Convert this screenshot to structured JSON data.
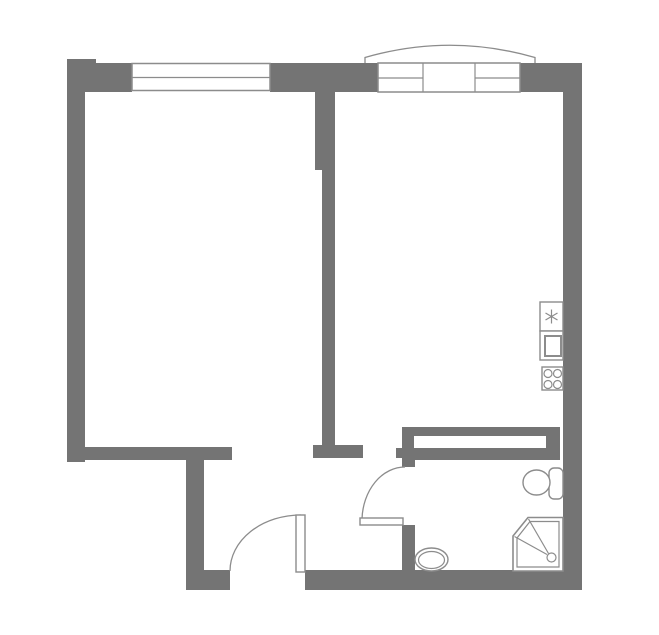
{
  "plan": {
    "width": 659,
    "height": 635,
    "colors": {
      "wall": "#747474",
      "line": "#8c8c8c",
      "white": "#ffffff",
      "background": "#ffffff"
    },
    "elements": [
      {
        "name": "top-left-corner-block",
        "shapes": [
          {
            "kind": "rect",
            "x": 67,
            "y": 59,
            "w": 29,
            "h": 33,
            "fill": "wall"
          }
        ]
      },
      {
        "name": "top-wall-left",
        "shapes": [
          {
            "kind": "rect",
            "x": 96,
            "y": 63,
            "w": 36,
            "h": 29,
            "fill": "wall"
          }
        ]
      },
      {
        "name": "top-wall-middle",
        "shapes": [
          {
            "kind": "rect",
            "x": 270,
            "y": 63,
            "w": 108,
            "h": 29,
            "fill": "wall"
          }
        ]
      },
      {
        "name": "top-wall-right",
        "shapes": [
          {
            "kind": "rect",
            "x": 518,
            "y": 63,
            "w": 64,
            "h": 29,
            "fill": "wall"
          }
        ]
      },
      {
        "name": "left-wall",
        "shapes": [
          {
            "kind": "rect",
            "x": 67,
            "y": 92,
            "w": 18,
            "h": 370,
            "fill": "wall"
          }
        ]
      },
      {
        "name": "right-wall",
        "shapes": [
          {
            "kind": "rect",
            "x": 563,
            "y": 92,
            "w": 19,
            "h": 498,
            "fill": "wall"
          }
        ]
      },
      {
        "name": "interior-wall-upper",
        "shapes": [
          {
            "kind": "rect",
            "x": 315,
            "y": 92,
            "w": 20,
            "h": 78,
            "fill": "wall"
          }
        ]
      },
      {
        "name": "interior-wall-lower",
        "shapes": [
          {
            "kind": "rect",
            "x": 322,
            "y": 170,
            "w": 13,
            "h": 278,
            "fill": "wall"
          }
        ]
      },
      {
        "name": "interior-wall-foot",
        "shapes": [
          {
            "kind": "rect",
            "x": 313,
            "y": 445,
            "w": 50,
            "h": 13,
            "fill": "wall"
          }
        ]
      },
      {
        "name": "living-room-south-wall",
        "shapes": [
          {
            "kind": "rect",
            "x": 67,
            "y": 447,
            "w": 165,
            "h": 13,
            "fill": "wall"
          }
        ]
      },
      {
        "name": "hall-west-wall",
        "shapes": [
          {
            "kind": "rect",
            "x": 186,
            "y": 447,
            "w": 18,
            "h": 143,
            "fill": "wall"
          }
        ]
      },
      {
        "name": "south-wall-left",
        "shapes": [
          {
            "kind": "rect",
            "x": 186,
            "y": 570,
            "w": 44,
            "h": 20,
            "fill": "wall"
          }
        ]
      },
      {
        "name": "south-wall-right",
        "shapes": [
          {
            "kind": "rect",
            "x": 305,
            "y": 570,
            "w": 277,
            "h": 20,
            "fill": "wall"
          }
        ]
      },
      {
        "name": "bathroom-wall-upper",
        "shapes": [
          {
            "kind": "rect",
            "x": 402,
            "y": 427,
            "w": 13,
            "h": 40,
            "fill": "wall"
          }
        ]
      },
      {
        "name": "bathroom-wall-nub",
        "shapes": [
          {
            "kind": "rect",
            "x": 396,
            "y": 448,
            "w": 20,
            "h": 10,
            "fill": "wall"
          }
        ]
      },
      {
        "name": "bathroom-wall-lower",
        "shapes": [
          {
            "kind": "rect",
            "x": 402,
            "y": 525,
            "w": 13,
            "h": 46,
            "fill": "wall"
          }
        ]
      },
      {
        "name": "bathroom-north-wall",
        "shapes": [
          {
            "kind": "rect",
            "x": 402,
            "y": 448,
            "w": 158,
            "h": 12,
            "fill": "wall"
          }
        ]
      },
      {
        "name": "built-in-wardrobe",
        "shapes": [
          {
            "kind": "rect",
            "x": 402,
            "y": 427,
            "w": 158,
            "h": 21,
            "fill": "wall"
          },
          {
            "kind": "rect",
            "x": 414,
            "y": 436,
            "w": 132,
            "h": 12,
            "fill": "white"
          }
        ]
      },
      {
        "name": "window-living-room",
        "shapes": [
          {
            "kind": "rect",
            "x": 132,
            "y": 63.5,
            "w": 138,
            "h": 27,
            "fill": "white",
            "stroke": "line",
            "sw": 1.5
          },
          {
            "kind": "line",
            "x1": 132,
            "y1": 77.5,
            "x2": 270,
            "y2": 77.5,
            "stroke": "line",
            "sw": 1.2
          }
        ]
      },
      {
        "name": "balcony-window-unit",
        "shapes": [
          {
            "kind": "rect",
            "x": 378,
            "y": 63,
            "w": 142,
            "h": 29,
            "fill": "white",
            "stroke": "line",
            "sw": 1.5
          },
          {
            "kind": "line",
            "x1": 423,
            "y1": 63,
            "x2": 423,
            "y2": 92,
            "stroke": "line",
            "sw": 1.2
          },
          {
            "kind": "line",
            "x1": 475,
            "y1": 63,
            "x2": 475,
            "y2": 92,
            "stroke": "line",
            "sw": 1.2
          },
          {
            "kind": "line",
            "x1": 378,
            "y1": 78,
            "x2": 423,
            "y2": 78,
            "stroke": "line",
            "sw": 1.2
          },
          {
            "kind": "line",
            "x1": 475,
            "y1": 78,
            "x2": 520,
            "y2": 78,
            "stroke": "line",
            "sw": 1.2
          }
        ]
      },
      {
        "name": "balcony-outline",
        "shapes": [
          {
            "kind": "path",
            "d": "M 365 63 L 365 57.5 Q 450 33 535 57.5 L 535 63",
            "fill": "none",
            "stroke": "line",
            "sw": 1.3
          }
        ]
      },
      {
        "name": "entrance-door",
        "shapes": [
          {
            "kind": "path",
            "d": "M 230 571 A 71 56 0 0 1 301 515",
            "fill": "none",
            "stroke": "line",
            "sw": 1.3
          },
          {
            "kind": "rect",
            "x": 296,
            "y": 515,
            "w": 9,
            "h": 57,
            "fill": "white",
            "stroke": "line",
            "sw": 1.4
          }
        ]
      },
      {
        "name": "bathroom-door",
        "shapes": [
          {
            "kind": "path",
            "d": "M 405 467 A 43 54 0 0 0 362 519",
            "fill": "none",
            "stroke": "line",
            "sw": 1.3
          },
          {
            "kind": "rect",
            "x": 360,
            "y": 518,
            "w": 43,
            "h": 7,
            "fill": "white",
            "stroke": "line",
            "sw": 1.4
          }
        ]
      },
      {
        "name": "kitchen-appliance-star",
        "shapes": [
          {
            "kind": "rect",
            "x": 540,
            "y": 302,
            "w": 23,
            "h": 29,
            "fill": "white",
            "stroke": "line",
            "sw": 1.4
          },
          {
            "kind": "line",
            "x1": 551.5,
            "y1": 309.5,
            "x2": 551.5,
            "y2": 323.5,
            "stroke": "line",
            "sw": 1.2
          },
          {
            "kind": "line",
            "x1": 545.5,
            "y1": 313,
            "x2": 557.5,
            "y2": 320,
            "stroke": "line",
            "sw": 1.2
          },
          {
            "kind": "line",
            "x1": 545.5,
            "y1": 320,
            "x2": 557.5,
            "y2": 313,
            "stroke": "line",
            "sw": 1.2
          }
        ]
      },
      {
        "name": "kitchen-sink",
        "shapes": [
          {
            "kind": "rect",
            "x": 540,
            "y": 331,
            "w": 23,
            "h": 29,
            "fill": "white",
            "stroke": "line",
            "sw": 1.4
          },
          {
            "kind": "rect",
            "x": 545,
            "y": 336,
            "w": 16,
            "h": 20,
            "fill": "white",
            "stroke": "line",
            "sw": 2
          }
        ]
      },
      {
        "name": "stove",
        "shapes": [
          {
            "kind": "rect",
            "x": 542,
            "y": 367,
            "w": 21,
            "h": 23,
            "fill": "white",
            "stroke": "line",
            "sw": 1.4
          },
          {
            "kind": "circle",
            "cx": 548,
            "cy": 373.5,
            "r": 4,
            "fill": "none",
            "stroke": "line",
            "sw": 1.2
          },
          {
            "kind": "circle",
            "cx": 557.5,
            "cy": 373.5,
            "r": 4,
            "fill": "none",
            "stroke": "line",
            "sw": 1.2
          },
          {
            "kind": "circle",
            "cx": 548,
            "cy": 384.5,
            "r": 4,
            "fill": "none",
            "stroke": "line",
            "sw": 1.2
          },
          {
            "kind": "circle",
            "cx": 557.5,
            "cy": 384.5,
            "r": 4,
            "fill": "none",
            "stroke": "line",
            "sw": 1.2
          }
        ]
      },
      {
        "name": "toilet",
        "shapes": [
          {
            "kind": "rect",
            "x": 549,
            "y": 468,
            "w": 14,
            "h": 31,
            "rx": 5,
            "fill": "white",
            "stroke": "line",
            "sw": 1.4
          },
          {
            "kind": "ellipse",
            "cx": 536.5,
            "cy": 482.5,
            "rx": 13.5,
            "ry": 12.5,
            "fill": "white",
            "stroke": "line",
            "sw": 1.4
          }
        ]
      },
      {
        "name": "shower",
        "shapes": [
          {
            "kind": "polygon",
            "points": "528,517.5 563,517.5 563,571 513,571 513,536",
            "fill": "white",
            "stroke": "line",
            "sw": 1.6
          },
          {
            "kind": "polygon",
            "points": "530,521.5 559,521.5 559,567 517,567 517,538",
            "fill": "none",
            "stroke": "line",
            "sw": 1.2
          },
          {
            "kind": "line",
            "x1": 514.5,
            "y1": 536.5,
            "x2": 547,
            "y2": 554.5,
            "stroke": "line",
            "sw": 1.2
          },
          {
            "kind": "line",
            "x1": 528.5,
            "y1": 519,
            "x2": 548.5,
            "y2": 553.5,
            "stroke": "line",
            "sw": 1.2
          },
          {
            "kind": "circle",
            "cx": 551.5,
            "cy": 557.5,
            "r": 4.5,
            "fill": "white",
            "stroke": "line",
            "sw": 1.2
          }
        ]
      },
      {
        "name": "washbasin",
        "shapes": [
          {
            "kind": "ellipse",
            "cx": 431.5,
            "cy": 559.5,
            "rx": 16.5,
            "ry": 11.5,
            "fill": "white",
            "stroke": "line",
            "sw": 1.4
          },
          {
            "kind": "ellipse",
            "cx": 431.5,
            "cy": 560,
            "rx": 13,
            "ry": 8.5,
            "fill": "none",
            "stroke": "line",
            "sw": 1.2
          }
        ]
      }
    ]
  }
}
